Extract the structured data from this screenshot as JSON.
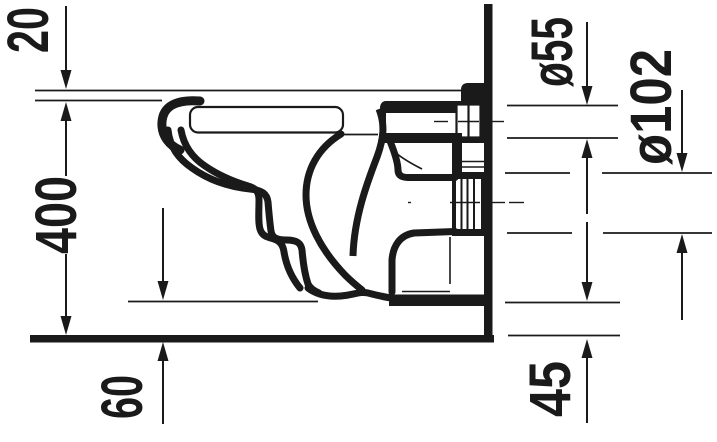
{
  "drawing": {
    "type": "technical-dimension-drawing",
    "subject": "wall-mounted-toilet-side-elevation",
    "unit_system": "mm",
    "dimensions": {
      "dim_20": {
        "label": "20"
      },
      "dim_400": {
        "label": "400"
      },
      "dim_60": {
        "label": "60"
      },
      "dim_55": {
        "label": "ø55"
      },
      "dim_102": {
        "label": "ø102"
      },
      "dim_45": {
        "label": "45"
      }
    },
    "colors": {
      "line": "#1a1a1a",
      "background": "#ffffff"
    }
  }
}
